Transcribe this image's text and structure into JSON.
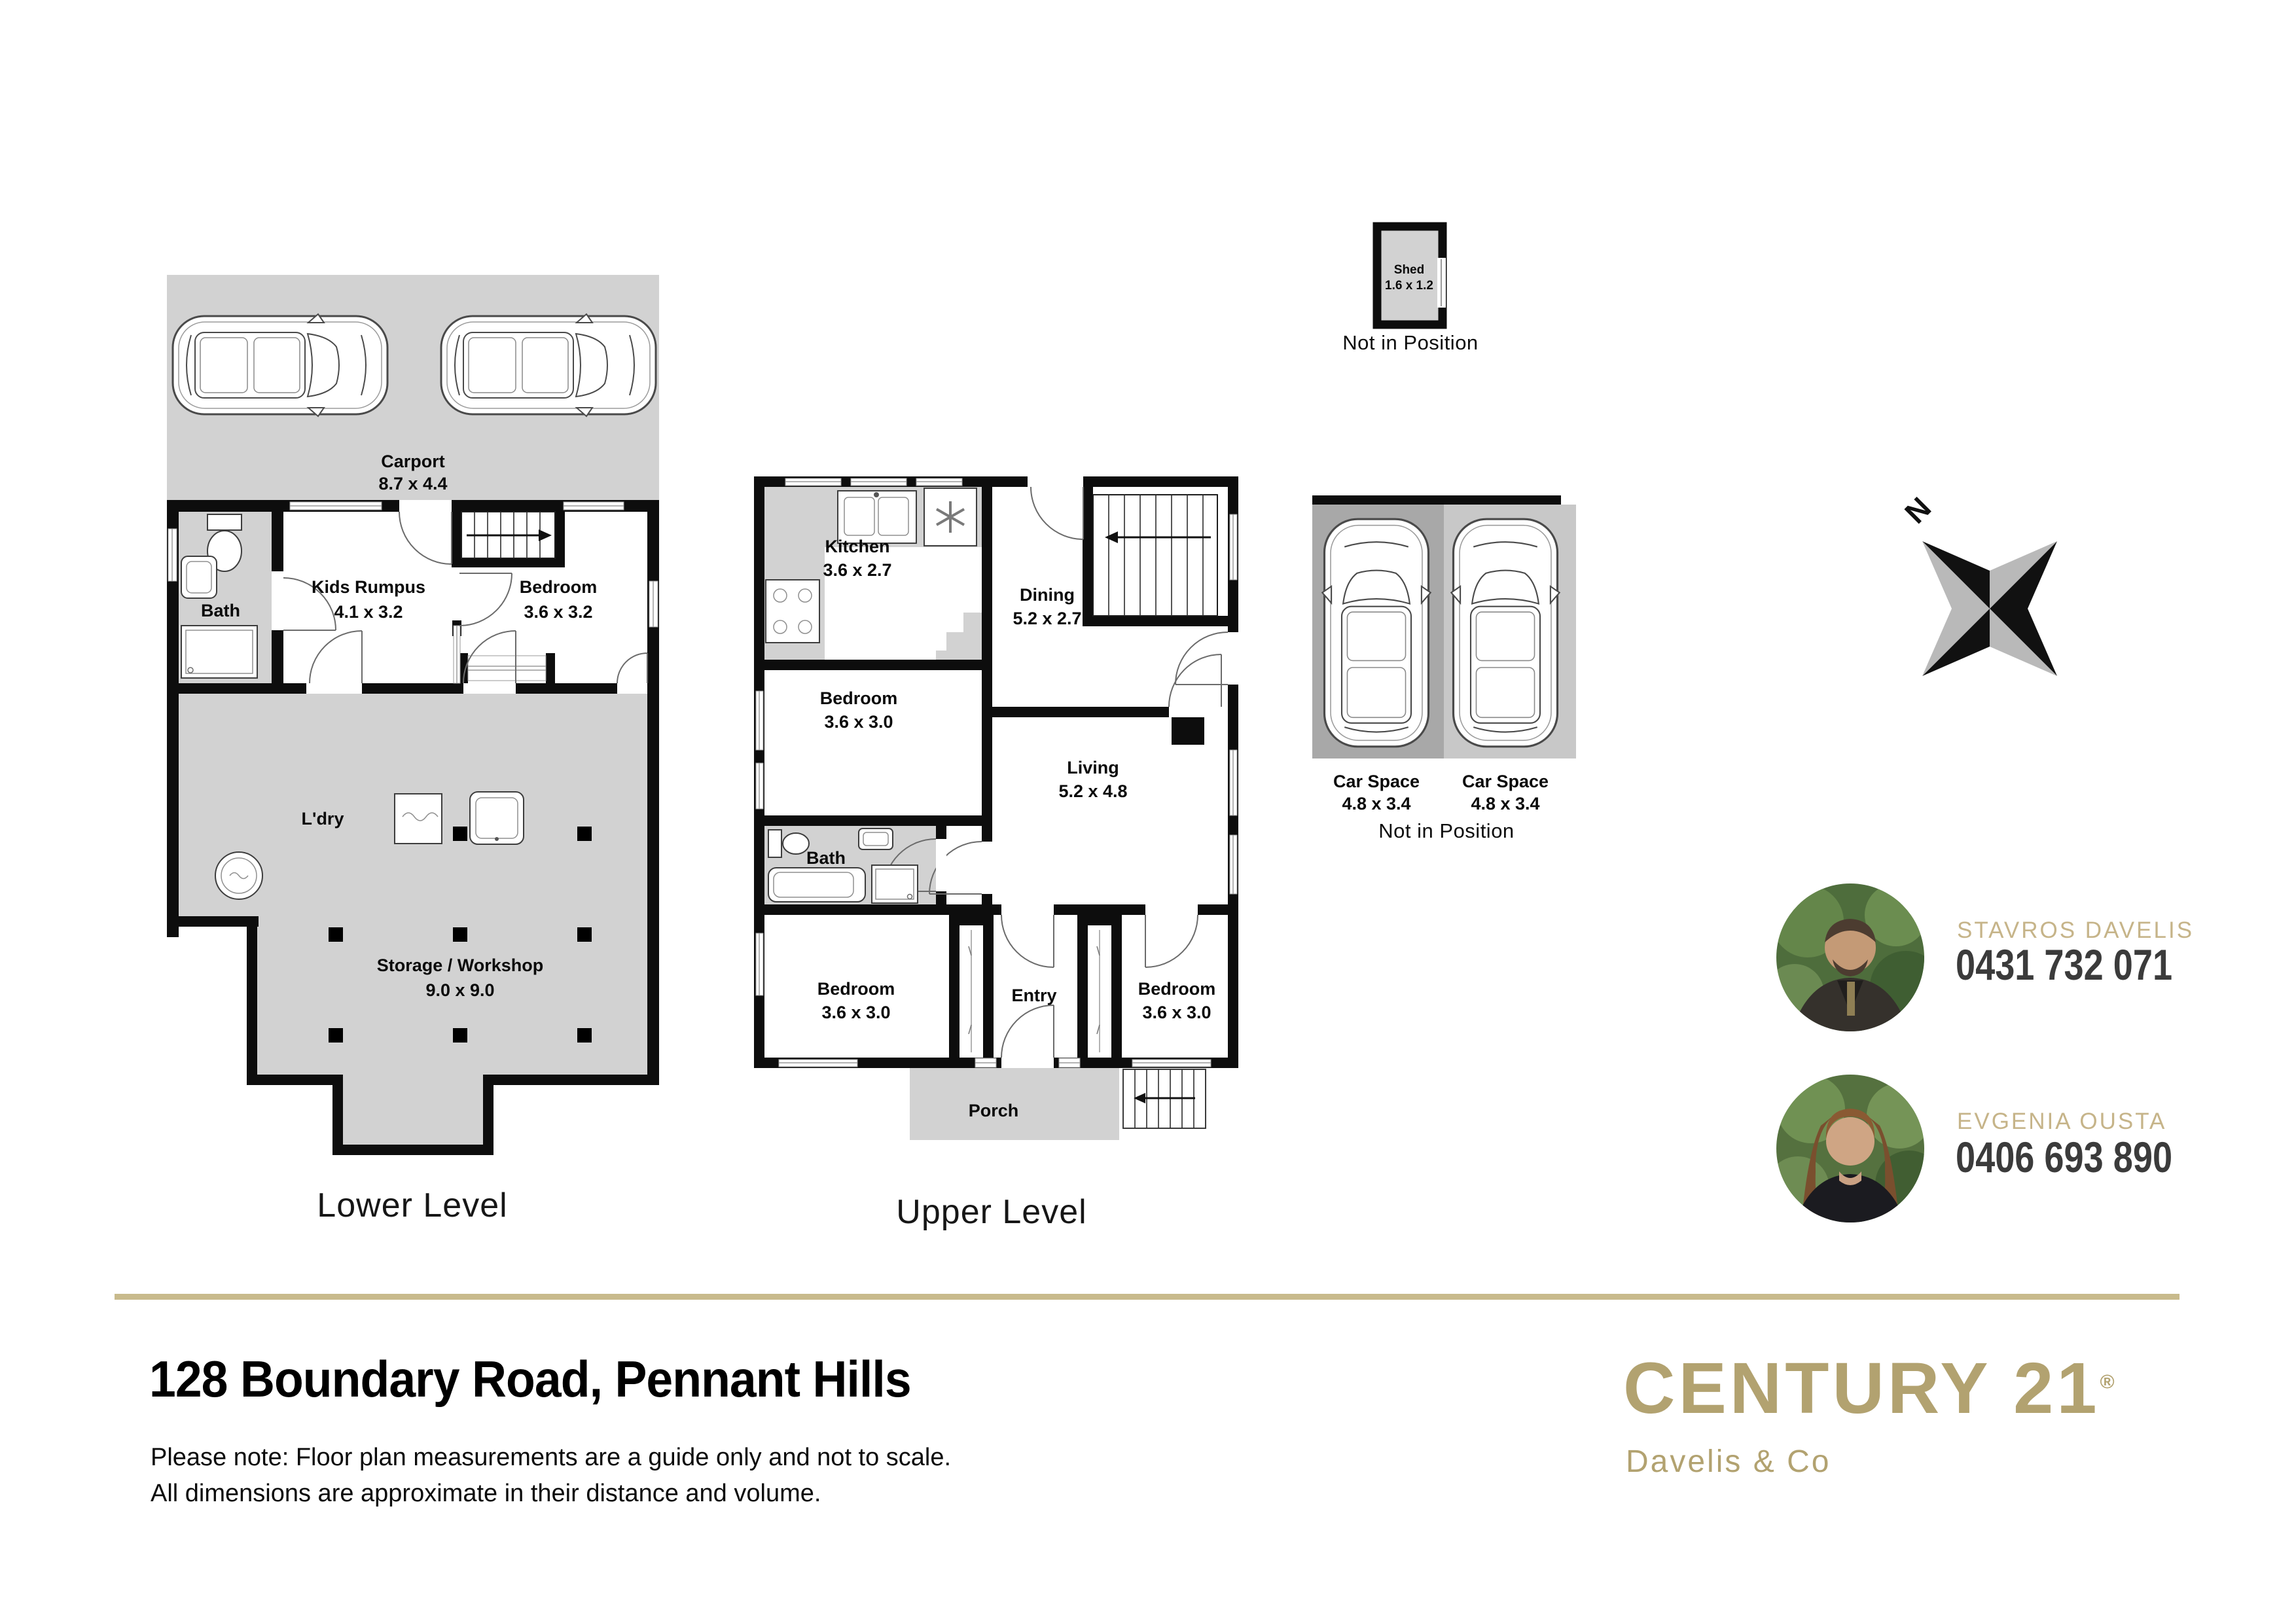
{
  "colors": {
    "floor_gray": "#d2d2d2",
    "pad_dark": "#a8a8a8",
    "pad_light": "#c8c8c8",
    "wall": "#0d0d0d",
    "gold_brand": "#b2a270",
    "gold_name": "#c6b489",
    "divider": "#c8ba8c"
  },
  "lower_level": {
    "caption": "Lower Level",
    "carport": {
      "name": "Carport",
      "dims": "8.7 x 4.4"
    },
    "bath": {
      "name": "Bath"
    },
    "rumpus": {
      "name": "Kids Rumpus",
      "dims": "4.1 x 3.2"
    },
    "bedroom": {
      "name": "Bedroom",
      "dims": "3.6 x 3.2"
    },
    "laundry": {
      "name": "L'dry"
    },
    "storage": {
      "name": "Storage / Workshop",
      "dims": "9.0 x 9.0"
    }
  },
  "upper_level": {
    "caption": "Upper Level",
    "kitchen": {
      "name": "Kitchen",
      "dims": "3.6 x 2.7"
    },
    "dining": {
      "name": "Dining",
      "dims": "5.2 x 2.7"
    },
    "bedroom1": {
      "name": "Bedroom",
      "dims": "3.6 x 3.0"
    },
    "living": {
      "name": "Living",
      "dims": "5.2 x 4.8"
    },
    "bath": {
      "name": "Bath"
    },
    "bedroom2": {
      "name": "Bedroom",
      "dims": "3.6 x 3.0"
    },
    "entry": {
      "name": "Entry"
    },
    "bedroom3": {
      "name": "Bedroom",
      "dims": "3.6 x 3.0"
    },
    "porch": {
      "name": "Porch"
    }
  },
  "shed": {
    "name": "Shed",
    "dims": "1.6 x 1.2",
    "note": "Not in Position"
  },
  "car_spaces": {
    "space1": {
      "name": "Car Space",
      "dims": "4.8 x 3.4"
    },
    "space2": {
      "name": "Car Space",
      "dims": "4.8 x 3.4"
    },
    "note": "Not in Position"
  },
  "compass": {
    "north": "N"
  },
  "agents": [
    {
      "name": "STAVROS DAVELIS",
      "phone": "0431 732 071"
    },
    {
      "name": "EVGENIA OUSTA",
      "phone": "0406 693 890"
    }
  ],
  "footer": {
    "address": "128 Boundary Road, Pennant Hills",
    "note1": "Please note: Floor plan measurements are a guide only and not to scale.",
    "note2": "All dimensions are approximate in their distance and volume.",
    "brand": "CENTURY 21",
    "brand_reg": "®",
    "brand_sub": "Davelis & Co"
  }
}
